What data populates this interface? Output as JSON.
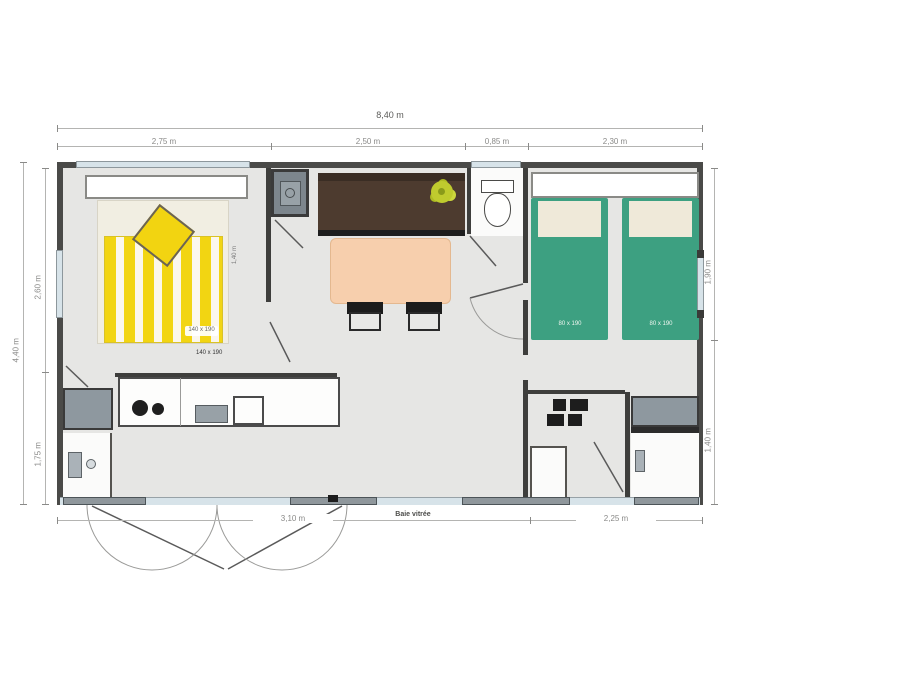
{
  "plan_title": "mobile-home-floor-plan",
  "dimensions": {
    "top_total": "8,40 m",
    "top_segments": [
      "2,75 m",
      "2,50 m",
      "0,85 m",
      "2,30 m"
    ],
    "left_total": "4,40 m",
    "left_segments": [
      "2,60 m",
      "1,75 m"
    ],
    "right_segments": [
      "1,90 m",
      "1,40 m"
    ],
    "bottom_segments": [
      "3,10 m",
      "2,25 m"
    ],
    "bottom_door_label": "Baie vitrée",
    "master_bed_side": "1,40 m"
  },
  "furniture": {
    "master_bed_label": "140 x 190",
    "master_bed_label_dark": "140 x 190",
    "twin_bed_left_label": "80 x 190",
    "twin_bed_right_label": "80 x 190"
  },
  "icons": {
    "plant": "plant-icon",
    "toilet": "toilet-icon",
    "stove": "stove-burners-icon",
    "sink": "sink-icon",
    "boiler": "boiler-icon",
    "washbasin": "washbasin-icon",
    "shower": "shower-icon",
    "appliance": "appliance-icon"
  },
  "colors": {
    "wall": "#4a4a48",
    "floor": "#e6e6e4",
    "bed_yellow": "#f2d512",
    "bed_green": "#3da081",
    "counter_brown": "#4d3b2f",
    "table_peach": "#f7cfad",
    "window_blue": "#d7e3e9",
    "cabinet_gray": "#8e989f",
    "plant_green": "#bfcb2e"
  }
}
